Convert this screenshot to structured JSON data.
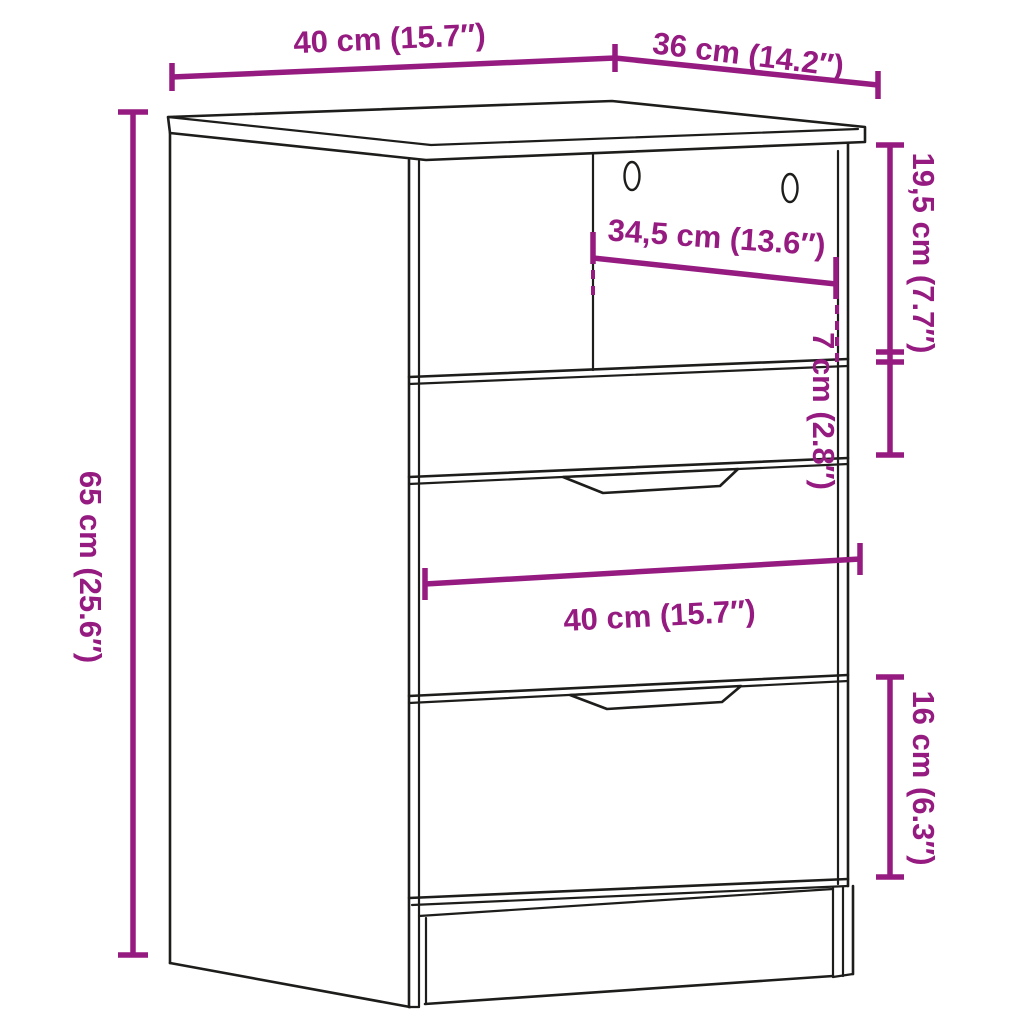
{
  "diagram": {
    "type": "furniture-dimension-diagram",
    "subject": "bedside cabinet with open compartment and three drawers",
    "accent_color": "#951b81",
    "line_color": "#1d1d1b",
    "background_color": "#ffffff",
    "dimensions": {
      "top_width": {
        "label": "40 cm (15.7″)",
        "value_cm": "40",
        "value_in": "15.7"
      },
      "top_depth": {
        "label": "36 cm (14.2″)",
        "value_cm": "36",
        "value_in": "14.2"
      },
      "inner_width": {
        "label": "34,5 cm (13.6″)",
        "value_cm": "34,5",
        "value_in": "13.6"
      },
      "upper_section_height": {
        "label": "19,5 cm (7.7″)",
        "value_cm": "19,5",
        "value_in": "7.7"
      },
      "small_drawer_height": {
        "label": "7 cm (2.8″)",
        "value_cm": "7",
        "value_in": "2.8"
      },
      "overall_height": {
        "label": "65 cm (25.6″)",
        "value_cm": "65",
        "value_in": "25.6"
      },
      "front_width": {
        "label": "40 cm (15.7″)",
        "value_cm": "40",
        "value_in": "15.7"
      },
      "bottom_drawer_height": {
        "label": "16 cm (6.3″)",
        "value_cm": "16",
        "value_in": "6.3"
      }
    }
  }
}
